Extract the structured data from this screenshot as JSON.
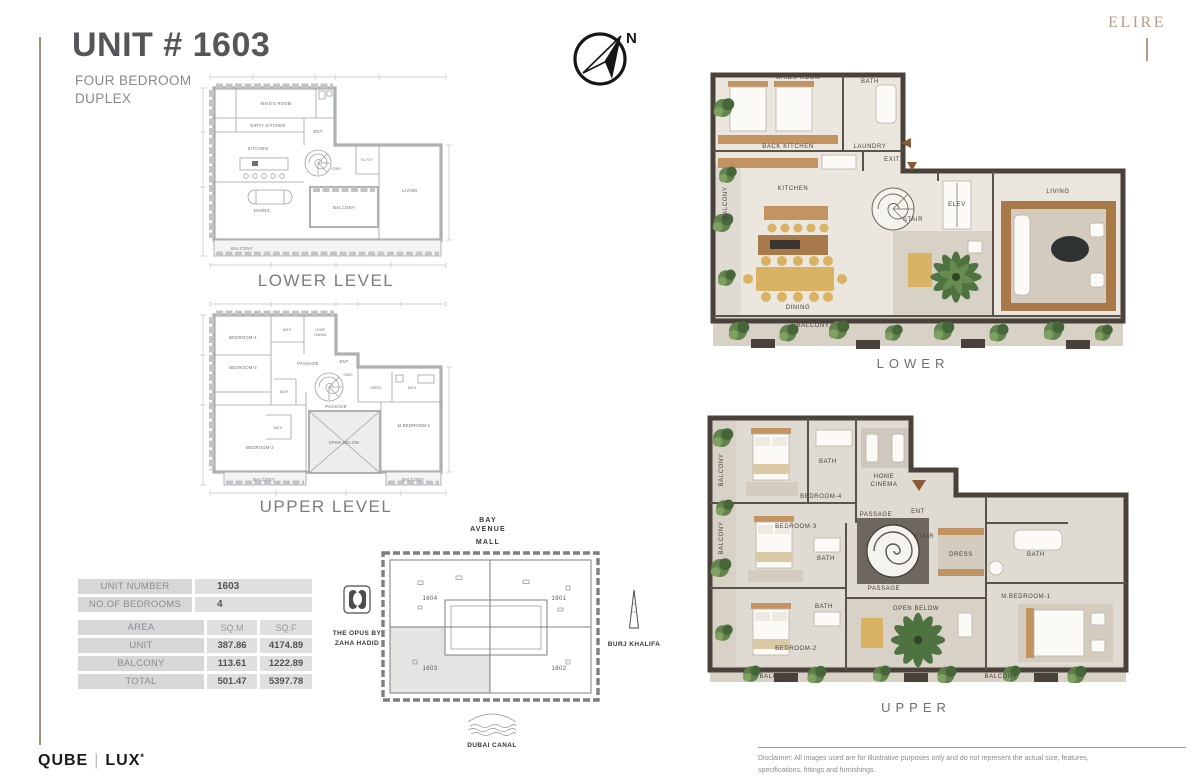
{
  "header": {
    "title": "UNIT # 1603",
    "subtitle_line1": "FOUR BEDROOM",
    "subtitle_line2": "DUPLEX"
  },
  "brand": {
    "elire": "ELIRE",
    "qube": "QUBE",
    "lux": "LUX",
    "lux_mark": "*"
  },
  "compass": {
    "north_label": "N"
  },
  "schematic_lower": {
    "caption": "LOWER LEVEL",
    "rooms": {
      "maids_room": "MAID'S ROOM",
      "dirty_kitchen": "DIRTY KITCHEN",
      "kitchen": "KITCHEN",
      "ent": "ENT",
      "stair": "STAIR",
      "el_foy": "EL.FOY",
      "living": "LIVING",
      "dining": "DINING",
      "balcony_mid": "BALCONY",
      "balcony_bottom": "BALCONY"
    }
  },
  "schematic_upper": {
    "caption": "UPPER LEVEL",
    "rooms": {
      "bedroom4": "BEDROOM-4",
      "bath_top": "BATH",
      "home_cinema_1": "HOME",
      "home_cinema_2": "CINEMA",
      "bedroom3": "BEDROOM-3",
      "passage_top": "PASSAGE",
      "ent": "ENT",
      "stair": "STAIR",
      "bath_mid": "BATH",
      "passage_mid": "PASSAGE",
      "dress": "DRESS",
      "bath_right": "BATH",
      "m_bedroom1": "M.BEDROOM-1",
      "bath_left": "BATH",
      "bedroom2": "BEDROOM-2",
      "open_below": "OPEN BELOW",
      "balcony_left": "BALCONY",
      "balcony_right": "BALCONY"
    }
  },
  "render_lower": {
    "caption": "LOWER",
    "rooms": {
      "maids_room": "MAIDS ROOM",
      "bath": "BATH",
      "back_kitchen": "BACK KITCHEN",
      "laundry": "LAUNDRY",
      "exit": "EXIT",
      "kitchen": "KITCHEN",
      "balcony_left": "BALCONY",
      "stair": "STAIR",
      "elev": "ELEV",
      "living": "LIVING",
      "dining": "DINING",
      "balcony_bottom": "BALCONY"
    }
  },
  "render_upper": {
    "caption": "UPPER",
    "rooms": {
      "balcony_top": "BALCONY",
      "bedroom4": "BEDROOM-4",
      "bath4": "BATH",
      "home_cinema_1": "HOME",
      "home_cinema_2": "CINEMA",
      "bedroom3": "BEDROOM-3",
      "bath3": "BATH",
      "balcony_mid": "BALCONY",
      "passage_top": "PASSAGE",
      "ent": "ENT",
      "stair": "STAIR",
      "dress": "DRESS",
      "bath_m": "BATH",
      "m_bedroom1": "M.BEDROOM-1",
      "bath2": "BATH",
      "bedroom2": "BEDROOM-2",
      "passage_mid": "PASSAGE",
      "open_below": "OPEN BELOW",
      "balcony_bl": "BALCONY",
      "balcony_br": "BALCONY"
    }
  },
  "site_plan": {
    "mall_line1": "BAY",
    "mall_line2": "AVENUE",
    "mall_line3": "MALL",
    "opus_line1": "THE OPUS BY",
    "opus_line2": "ZAHA HADID",
    "burj": "BURJ KHALIFA",
    "canal": "DUBAI CANAL",
    "unit_tl": "1604",
    "unit_tr": "1601",
    "unit_bl": "1603",
    "unit_br": "1602",
    "highlighted_unit": "1603"
  },
  "table": {
    "unit_number_label": "UNIT NUMBER",
    "unit_number_value": "1603",
    "bedrooms_label": "NO.OF BEDROOMS",
    "bedrooms_value": "4",
    "area_label": "AREA",
    "sqm_label": "SQ.M",
    "sqf_label": "SQ.F",
    "rows": [
      {
        "label": "UNIT",
        "sqm": "387.86",
        "sqf": "4174.89"
      },
      {
        "label": "BALCONY",
        "sqm": "113.61",
        "sqf": "1222.89"
      },
      {
        "label": "TOTAL",
        "sqm": "501.47",
        "sqf": "5397.78"
      }
    ]
  },
  "footer": {
    "disclaimer_line1": "Disclaimer: All images used are for illustrative purposes only and do not represent the actual size, features,",
    "disclaimer_line2": "specifications, fittings and furnishings."
  },
  "colors": {
    "accent_tan": "#a39180",
    "elire_gold": "#b29c85",
    "title_gray": "#55565a",
    "wall_dark": "#49423b",
    "wood": "#c29461",
    "plant_green": "#5d7f48",
    "highlight_fill": "#e4e4e2"
  }
}
